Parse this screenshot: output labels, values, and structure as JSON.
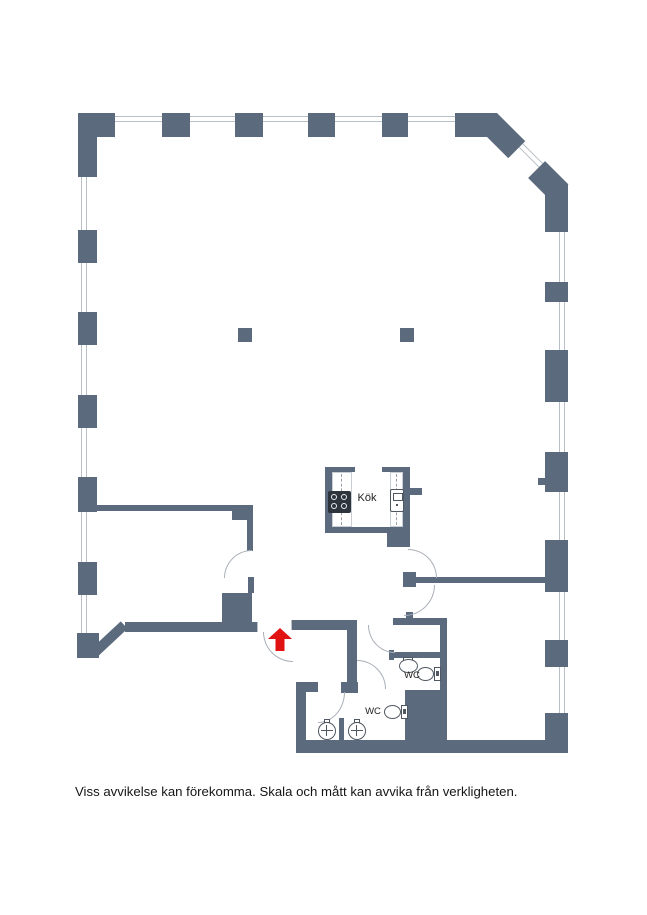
{
  "labels": {
    "kitchen": "Kök",
    "wc_upper": "WC",
    "wc_lower": "WC"
  },
  "caption": "Viss avvikelse kan förekomma. Skala och mått kan avvika från verkligheten.",
  "icons": {
    "entrance_arrow": "red arrow marking apartment entrance",
    "stove": "4-burner stove",
    "kitchen_sink": "kitchen sink",
    "toilet": "toilet",
    "washbasin": "washbasin"
  },
  "colors": {
    "wall": "#5b6a7d",
    "window_line": "#b9bfc7",
    "arc": "#a9afb8",
    "fixture": "#4f5862",
    "stove": "#2e343b",
    "arrow": "#e01212",
    "text": "#222222"
  }
}
